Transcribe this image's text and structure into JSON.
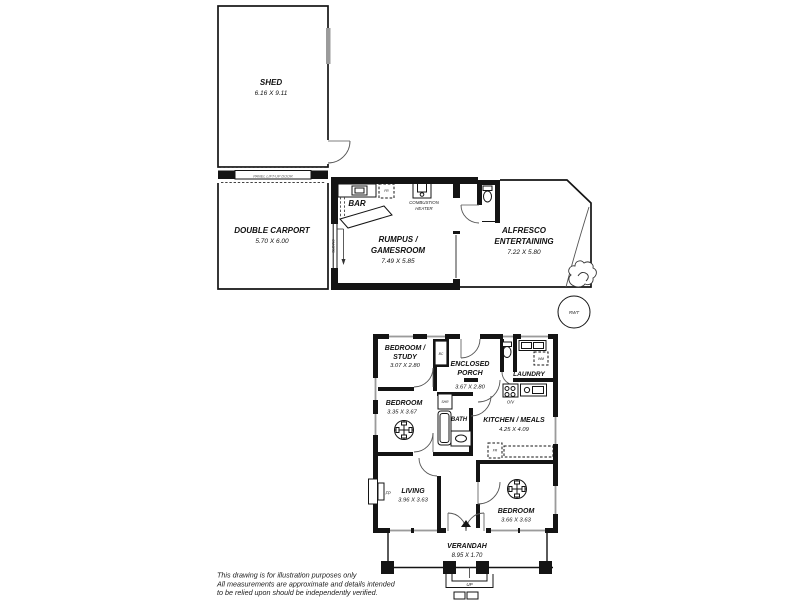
{
  "plan": {
    "shed": {
      "name": "SHED",
      "dims": "6.16 X 9.11"
    },
    "panel_door": "PANEL LIFT-UP DOOR",
    "carport": {
      "name": "DOUBLE CARPORT",
      "dims": "5.70 X 6.00"
    },
    "rumpus": {
      "line1": "RUMPUS /",
      "line2": "GAMESROOM",
      "dims": "7.49 X 5.85"
    },
    "bar": {
      "label": "BAR",
      "fridge": "FR"
    },
    "heater": {
      "line1": "COMBUSTION",
      "line2": "HEATER"
    },
    "sliding": "SLIDING",
    "alfresco": {
      "line1": "ALFRESCO",
      "line2": "ENTERTAINING",
      "dims": "7.22 X 5.80"
    },
    "rwt": "RWT",
    "house": {
      "bedroom_study": {
        "line1": "BEDROOM /",
        "line2": "STUDY",
        "dims": "3.07 X 2.80",
        "closet": "BC"
      },
      "enclosed_porch": {
        "line1": "ENCLOSED",
        "line2": "PORCH",
        "dims": "3.67 X 2.80"
      },
      "laundry": {
        "name": "LAUNDRY",
        "wm": "WM",
        "ov": "O/V"
      },
      "bedroom2": {
        "name": "BEDROOM",
        "dims": "3.35 X 3.67"
      },
      "bath": {
        "name": "BATH",
        "shower": "SHR"
      },
      "kitchen": {
        "name": "KITCHEN / MEALS",
        "dims": "4.25 X 4.09",
        "fridge": "FR"
      },
      "living": {
        "name": "LIVING",
        "dims": "3.96 X 3.63",
        "fireplace": "FP"
      },
      "bedroom3": {
        "name": "BEDROOM",
        "dims": "3.66 X 3.63"
      },
      "verandah": {
        "name": "VERANDAH",
        "dims": "8.95 X 1.70",
        "steps": "UP"
      }
    },
    "disclaimer": {
      "line1": "This drawing is for illustration purposes only",
      "line2": "All measurements are approximate and details intended",
      "line3": "to be relied upon should be independently verified."
    }
  }
}
